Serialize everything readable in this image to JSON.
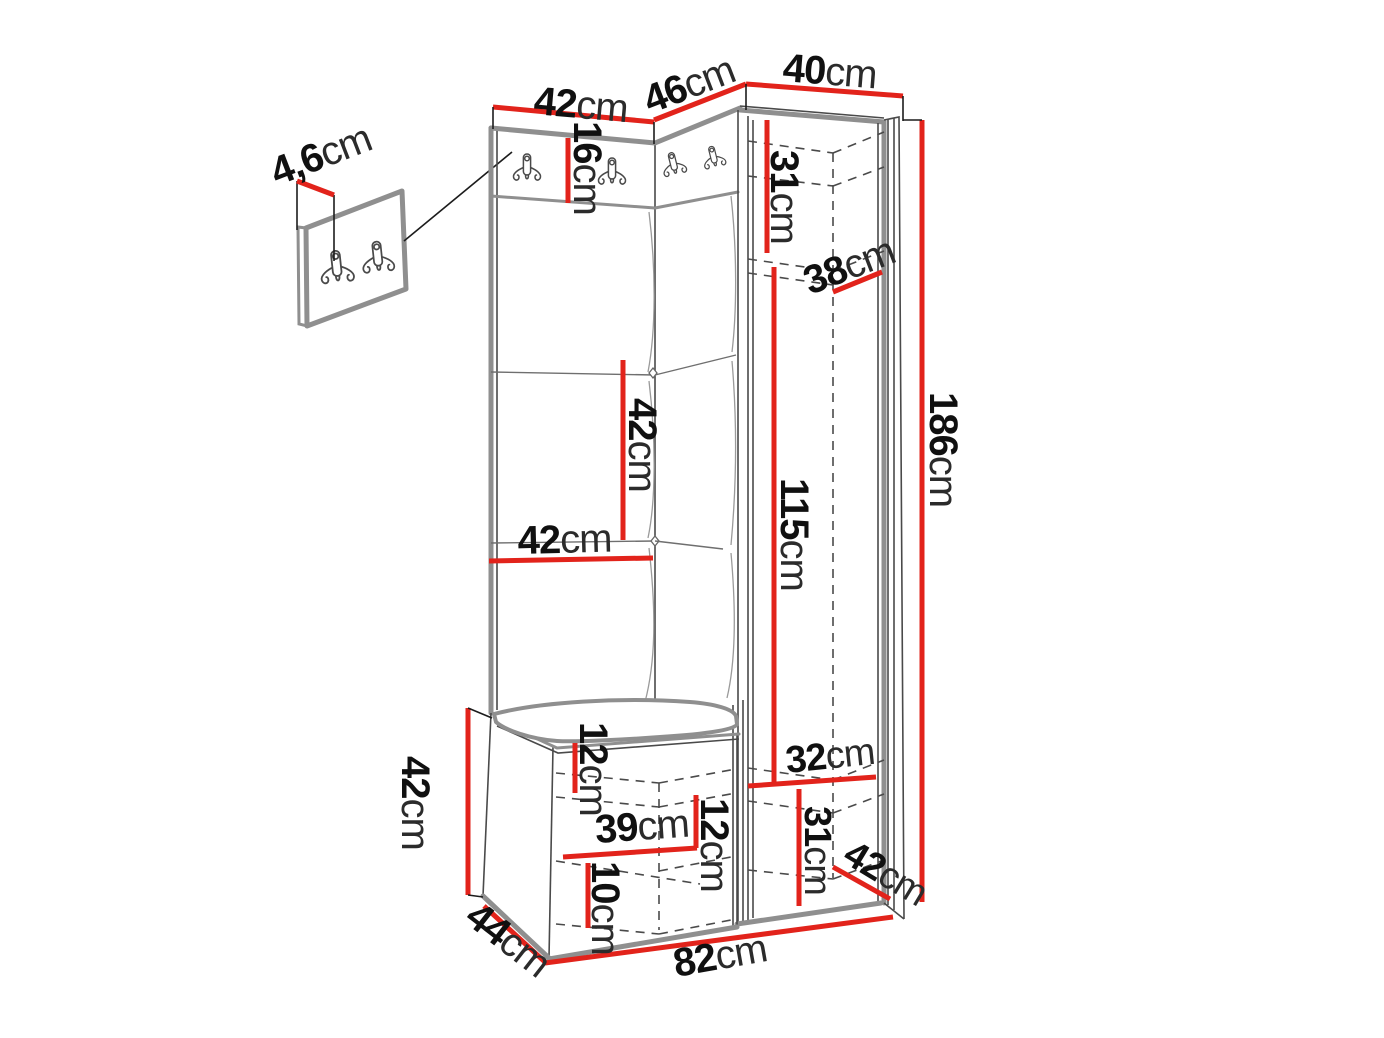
{
  "figure": {
    "kind": "hallway-furniture-dimension-diagram",
    "unit": "cm",
    "accent_color": "#e2231b",
    "outline_color": "#8f8f8f",
    "background_color": "#ffffff"
  },
  "dimensions": {
    "detail_thickness": {
      "value": "4,6",
      "unit": "cm"
    },
    "top_width_left": {
      "value": "42",
      "unit": "cm"
    },
    "top_width_corner": {
      "value": "46",
      "unit": "cm"
    },
    "top_width_right": {
      "value": "40",
      "unit": "cm"
    },
    "hook_panel_height": {
      "value": "16",
      "unit": "cm"
    },
    "wardrobe_top_shelf_height": {
      "value": "31",
      "unit": "cm"
    },
    "wardrobe_depth": {
      "value": "38",
      "unit": "cm"
    },
    "total_height": {
      "value": "186",
      "unit": "cm"
    },
    "panel_tile_height": {
      "value": "42",
      "unit": "cm"
    },
    "panel_tile_width": {
      "value": "42",
      "unit": "cm"
    },
    "hanging_space_height": {
      "value": "115",
      "unit": "cm"
    },
    "bench_height": {
      "value": "42",
      "unit": "cm"
    },
    "bench_board_offset": {
      "value": "12",
      "unit": "cm"
    },
    "bench_shelf_width": {
      "value": "39",
      "unit": "cm"
    },
    "bench_mid_offset": {
      "value": "12",
      "unit": "cm"
    },
    "bench_bottom_offset": {
      "value": "10",
      "unit": "cm"
    },
    "bench_depth": {
      "value": "44",
      "unit": "cm"
    },
    "total_width": {
      "value": "82",
      "unit": "cm"
    },
    "wardrobe_bottom_shelf_width": {
      "value": "32",
      "unit": "cm"
    },
    "wardrobe_bottom_height": {
      "value": "31",
      "unit": "cm"
    },
    "wardrobe_bottom_depth": {
      "value": "42",
      "unit": "cm"
    }
  }
}
